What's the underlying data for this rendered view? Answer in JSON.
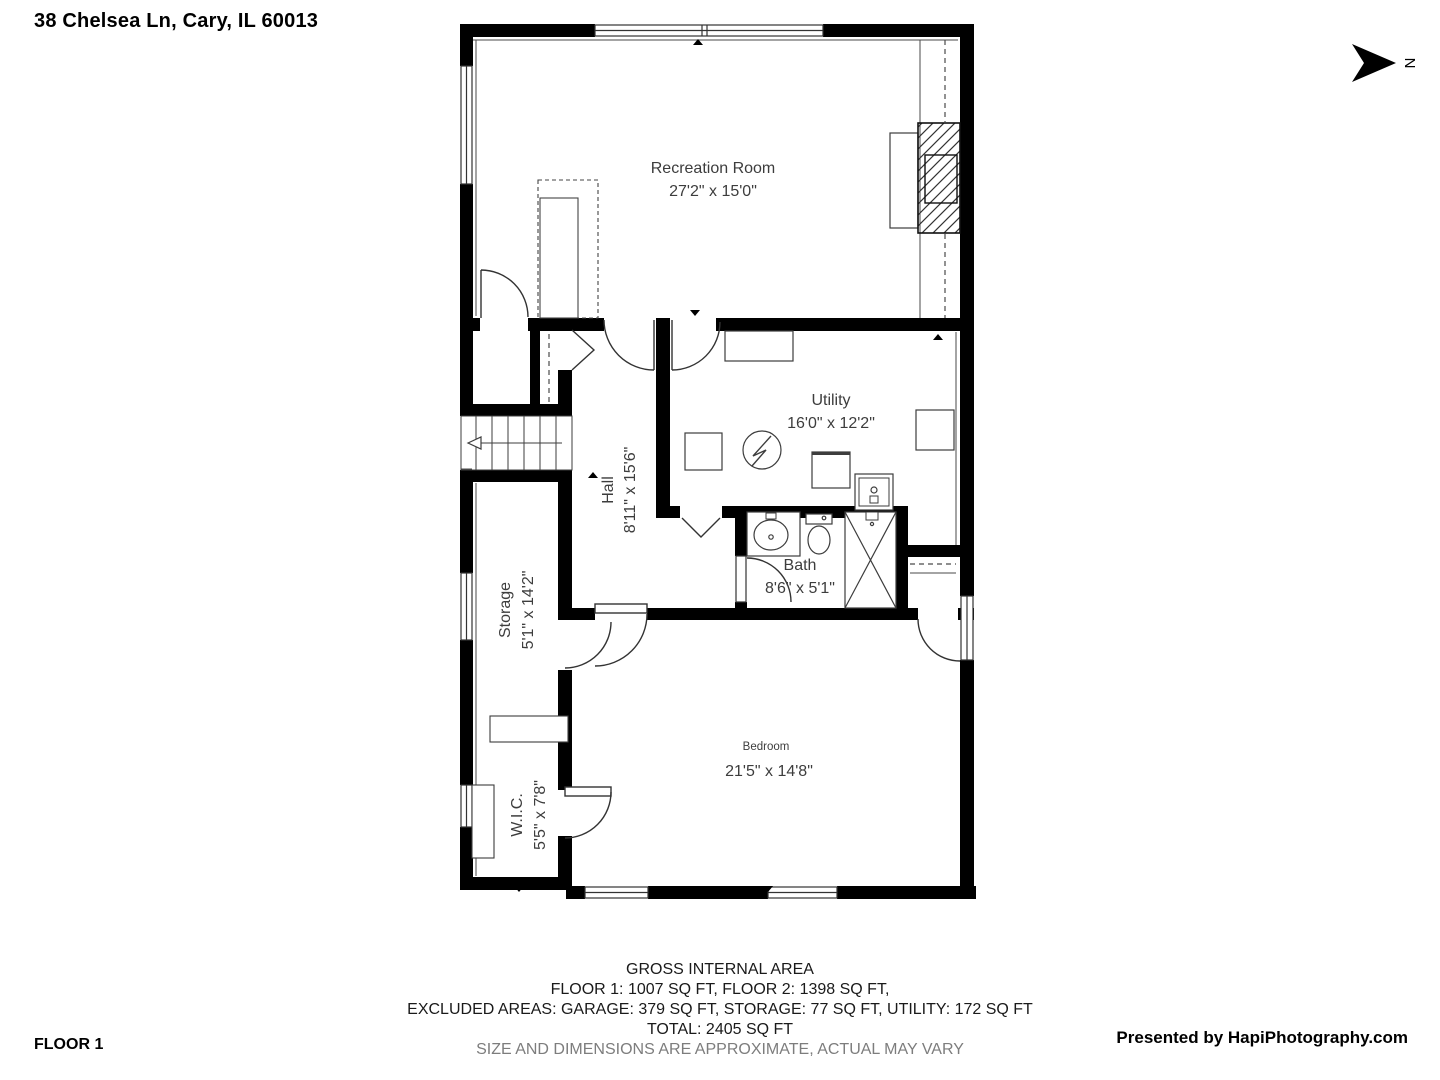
{
  "header": {
    "address": "38 Chelsea Ln, Cary, IL 60013"
  },
  "compass": {
    "north_label": "N"
  },
  "rooms": {
    "recreation": {
      "name": "Recreation Room",
      "dims": "27'2\" x 15'0\""
    },
    "utility": {
      "name": "Utility",
      "dims": "16'0\" x 12'2\""
    },
    "hall": {
      "name": "Hall",
      "dims": "8'11\" x 15'6\""
    },
    "bath": {
      "name": "Bath",
      "dims": "8'6\" x 5'1\""
    },
    "storage": {
      "name": "Storage",
      "dims": "5'1\" x 14'2\""
    },
    "wic": {
      "name": "W.I.C.",
      "dims": "5'5\" x 7'8\""
    },
    "bedroom": {
      "name": "Bedroom",
      "dims": "21'5\" x 14'8\""
    }
  },
  "footer": {
    "area_title": "GROSS INTERNAL AREA",
    "floors_line": "FLOOR 1: 1007 SQ FT, FLOOR 2: 1398 SQ FT,",
    "excluded_line": "EXCLUDED AREAS: GARAGE: 379 SQ FT, STORAGE: 77 SQ FT, UTILITY: 172 SQ FT",
    "total_line": "TOTAL: 2405 SQ FT",
    "disclaimer": "SIZE AND DIMENSIONS ARE APPROXIMATE, ACTUAL MAY VARY",
    "floor_label": "FLOOR 1",
    "credit": "Presented by HapiPhotography.com"
  },
  "colors": {
    "wall": "#000000",
    "line": "#3d3d3d",
    "muted_text": "#7d7d7d"
  }
}
